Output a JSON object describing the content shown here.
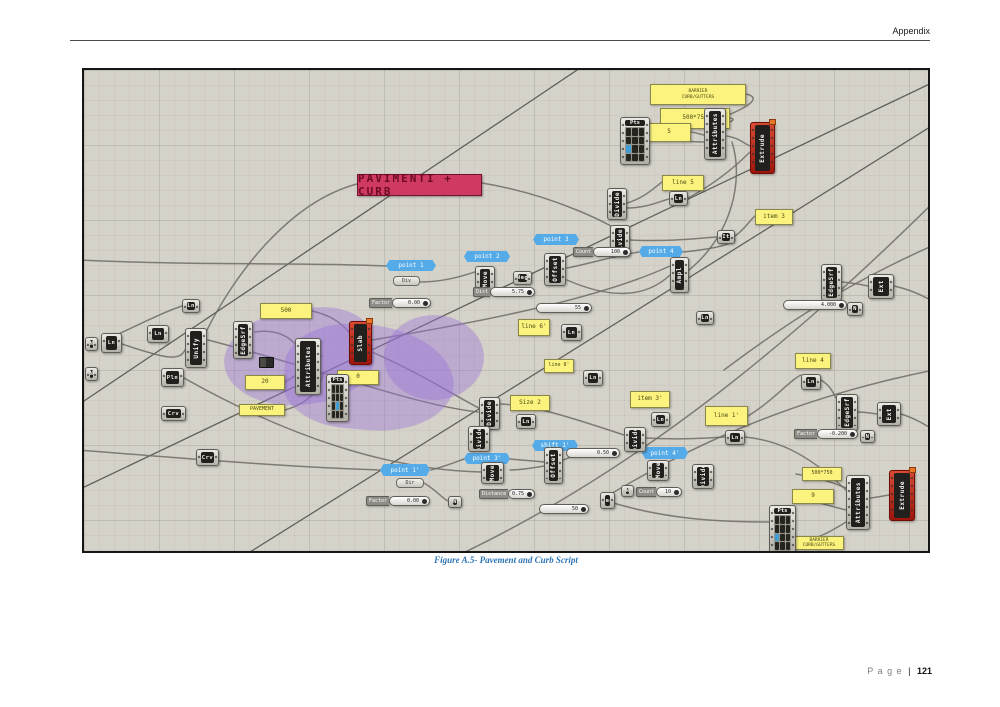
{
  "header": {
    "title": "Appendix"
  },
  "figure": {
    "caption": "Figure A.5- Pavement and Curb Script"
  },
  "footer": {
    "page_word": "P a g e",
    "separator": "|",
    "page_number": "121"
  },
  "diagram": {
    "title_panel": "PAVIMENTI + CURB",
    "panels": {
      "barrier_top": "BARRIER\nCURB/GUTTERS",
      "size_top": "500*750",
      "b_top": "5",
      "line5": "line 5",
      "item3": "item 3",
      "p500": "500",
      "p20": "20",
      "pavement": "PAVEMENT",
      "p0": "0",
      "size2": "Size 2",
      "line6": "line 6'",
      "line8": "line 8'",
      "item3p": "item 3'",
      "line1p": "line 1'",
      "line4": "line 4",
      "size_bottom": "500*750",
      "b_bottom": "9",
      "barrier_bottom": "BARRIER\nCURB/GUTTERS"
    },
    "labels": {
      "point1": "point 1",
      "point2": "point 2",
      "point3": "point 3",
      "point4": "point 4",
      "point1p": "point 1'",
      "point3p": "point 3'",
      "shift1p": "shift 1'",
      "point4p": "point 4'"
    },
    "components": {
      "attributes": "Attributes",
      "extrude": "Extrude",
      "pts": "Pts",
      "divide": "Divide",
      "ln": "Ln",
      "it": "It",
      "move": "Move",
      "neg": "Neg",
      "offset": "Offset",
      "ampl": "Ampl",
      "edgesrf": "EdgeSrf",
      "slab": "Slab",
      "unify": "Unify",
      "pln": "Pln",
      "crv": "Crv",
      "ext": "Ext",
      "n": "N",
      "div": "Div",
      "dir": "Dir"
    },
    "sliders": {
      "count100": {
        "name": "Count",
        "value": "100"
      },
      "dist575": {
        "name": "Dist",
        "value": "5.75"
      },
      "val55": {
        "name": "",
        "value": "55"
      },
      "factor_a": {
        "name": "Factor",
        "value": "0.00"
      },
      "factor_b": {
        "name": "Factor",
        "value": "0.00"
      },
      "dist050": {
        "name": "",
        "value": "0.50"
      },
      "distance075": {
        "name": "Distance",
        "value": "0.75"
      },
      "off50": {
        "name": "",
        "value": "50"
      },
      "count10": {
        "name": "Count",
        "value": "10"
      },
      "val4000": {
        "name": "",
        "value": "4.000"
      },
      "factor0200": {
        "name": "Factor",
        "value": "-0.200"
      }
    }
  }
}
